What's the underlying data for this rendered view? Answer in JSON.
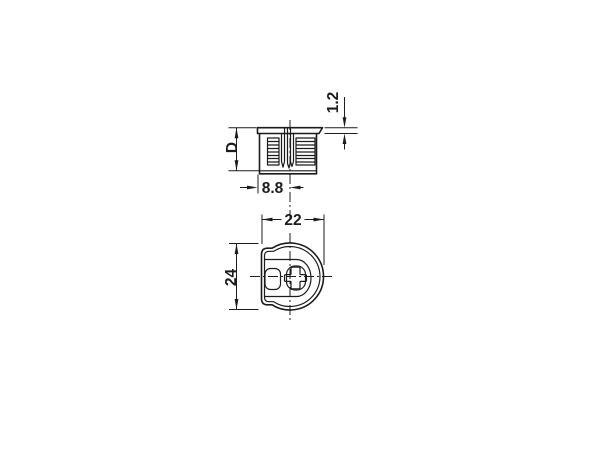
{
  "colors": {
    "background": "#ffffff",
    "line": "#1c1c1c"
  },
  "dimensions": {
    "d": "D",
    "edge_to_center": "8.8",
    "flange_thickness": "1.2",
    "width": "22",
    "height": "24"
  }
}
